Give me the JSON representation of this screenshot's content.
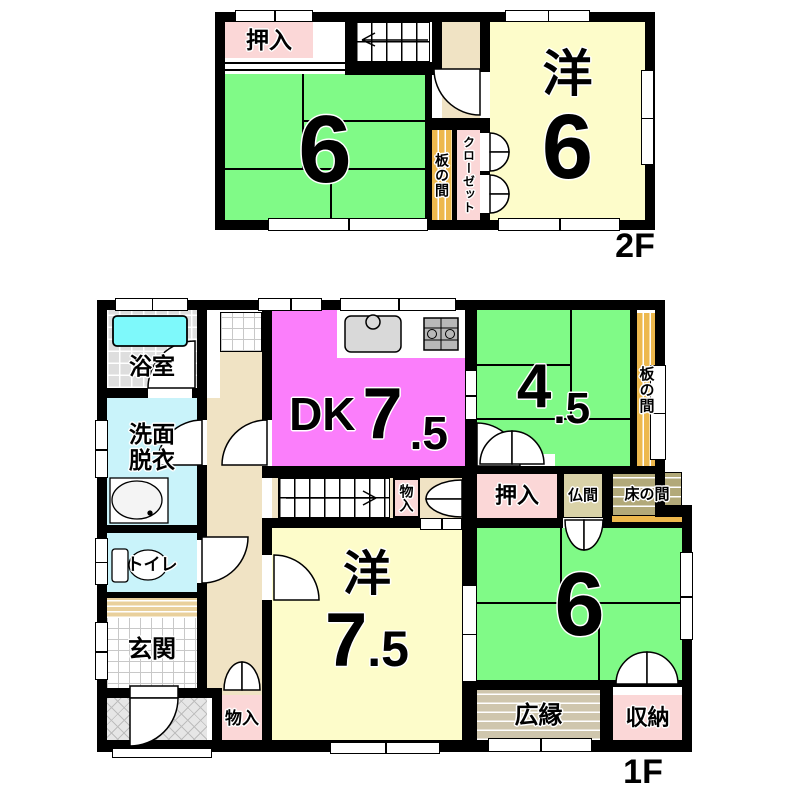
{
  "colors": {
    "tatami_green": "#80fa87",
    "western_yellow": "#fdfcca",
    "dk_magenta": "#fb7efb",
    "closet_pink": "#fbd7d7",
    "wood_orange": "#edb84d",
    "hall_beige": "#f0e3c4",
    "water_cyan": "#c9f3fa",
    "tub_cyan": "#7ef9fb",
    "bath_tile_gray": "#dedede",
    "veranda_tan": "#cfc6ad",
    "tokonoma_khaki": "#b2a979",
    "step_tan": "#e9d09c",
    "wall_black": "#000000"
  },
  "floor2": {
    "label": "2F",
    "oshiire": "押入",
    "tatami6": "6",
    "itanoma": "板の間",
    "closet": "クローゼット",
    "western_prefix": "洋",
    "western_size": "6"
  },
  "floor1": {
    "label": "1F",
    "bath": "浴室",
    "washroom_line1": "洗面",
    "washroom_line2": "脱衣",
    "toilet": "トイレ",
    "entrance": "玄関",
    "dk_name": "DK",
    "dk_size_int": "7",
    "dk_size_dec": ".5",
    "tatami45_int": "4",
    "tatami45_dec": ".5",
    "itanoma": "板の間",
    "oshiire": "押入",
    "butsuma": "仏間",
    "tokonoma": "床の間",
    "storage_hall": "物入",
    "storage_entry": "物入",
    "western_prefix": "洋",
    "western_size_int": "7",
    "western_size_dec": ".5",
    "tatami6": "6",
    "veranda": "広縁",
    "storage_south": "収納"
  }
}
